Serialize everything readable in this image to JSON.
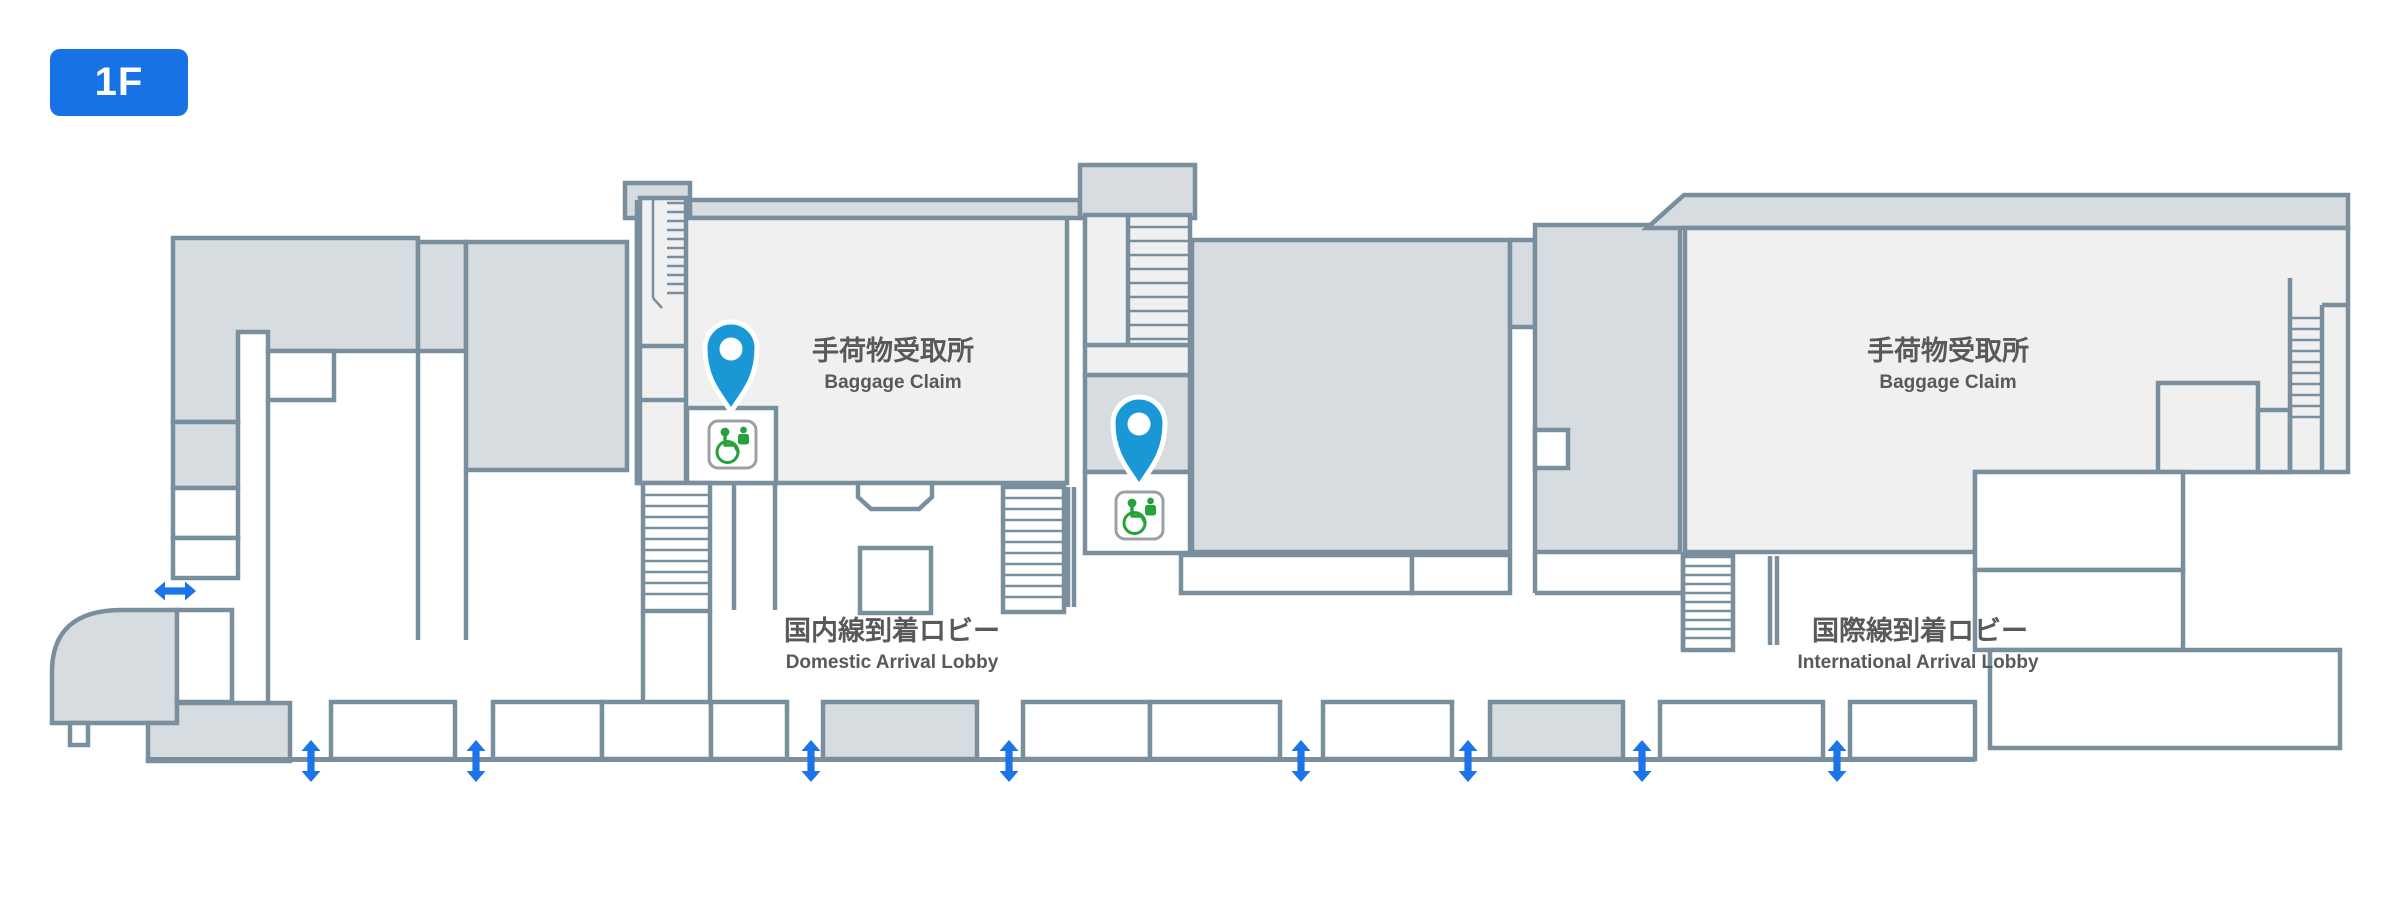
{
  "window": {
    "floor_badge": "1F"
  },
  "map": {
    "areas": {
      "baggage_claim_domestic": {
        "jp": "手荷物受取所",
        "en": "Baggage Claim"
      },
      "baggage_claim_international": {
        "jp": "手荷物受取所",
        "en": "Baggage Claim"
      },
      "domestic_arrival_lobby": {
        "jp": "国内線到着ロビー",
        "en": "Domestic Arrival Lobby"
      },
      "international_arrival_lobby": {
        "jp": "国際線到着ロビー",
        "en": "International Arrival Lobby"
      }
    },
    "markers": [
      {
        "id": "accessible-toilet-domestic",
        "icon": "location-pin-icon",
        "symbol": "wheelchair-accessible-toilet-icon"
      },
      {
        "id": "accessible-toilet-international",
        "icon": "location-pin-icon",
        "symbol": "wheelchair-accessible-toilet-icon"
      }
    ],
    "entrance_arrows": {
      "vertical_count": 8,
      "horizontal_count": 1
    }
  },
  "colors": {
    "accent_blue": "#1772E6",
    "arrow_blue": "#1B74E8",
    "pin_blue": "#1A98D6",
    "icon_green": "#27A23B",
    "wall": "#7A8F9D",
    "room_gray": "#D6DCE0",
    "room_light": "#F0F0F0",
    "icon_border": "#9AA0A4",
    "label_text": "#58595B"
  }
}
